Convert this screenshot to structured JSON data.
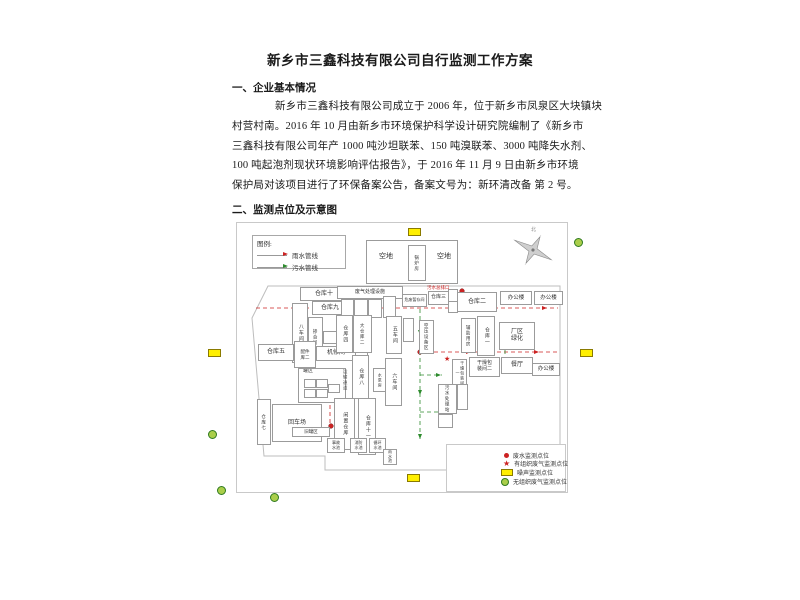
{
  "document": {
    "title": "新乡市三鑫科技有限公司自行监测工作方案",
    "section1": "一、企业基本情况",
    "paragraph": [
      "新乡市三鑫科技有限公司成立于 2006 年，位于新乡市凤泉区大块镇块",
      "村营村南。2016 年 10 月由新乡市环境保护科学设计研究院编制了《新乡市",
      "三鑫科技有限公司年产 1000 吨沙坦联苯、150 吨溴联苯、3000 吨降失水剂、",
      "100 吨起泡剂现状环境影响评估报告》，于 2016 年 11 月 9 日由新乡市环境",
      "保护局对该项目进行了环保备案公告，备案文号为：新环清改备 第 2 号。"
    ],
    "section2": "二、监测点位及示意图"
  },
  "diagram": {
    "compass_label": "北",
    "symbols": {
      "star": "★"
    },
    "pipe_legend": {
      "title": "图例:",
      "rain": "雨水管线",
      "sewage": "污水管线",
      "rain_color": "#cc2222",
      "sewage_color": "#2e8b2e"
    },
    "point_legend": [
      {
        "symbol": "red-dot",
        "label": "废水监测点位",
        "color": "#cc2222"
      },
      {
        "symbol": "red-star",
        "label": "有组织废气监测点位",
        "color": "#cc2222"
      },
      {
        "symbol": "yellow-rect",
        "label": "噪声监测点位",
        "color": "#ffef00"
      },
      {
        "symbol": "green-circle",
        "label": "无组织废气监测点位",
        "color": "#aace4a"
      }
    ],
    "labels": {
      "outlet": "污水总排口"
    },
    "buildings": {
      "empty_lot_left": "空地",
      "empty_lot_right": "空地",
      "boiler_room": "锅炉房",
      "warehouse10": "仓库十",
      "warehouse9": "仓库九",
      "workshop8": "八车间",
      "blending_room": "掺合间",
      "warehouse5": "仓库五",
      "parts_warehouse2": "配件库二",
      "machine_repair": "机修间",
      "tank_area": "罐区",
      "old_tank_area": "旧罐区",
      "warehouse7": "仓库七",
      "turning_yard": "回车场",
      "idle_warehouse": "闲置仓库",
      "warehouse11": "仓库十一",
      "transport_corridor": "运输通道",
      "warehouse8": "仓库八",
      "pump_room": "水泵房",
      "workshop6": "六车间",
      "warehouse4": "仓库四",
      "big_warehouse2": "大仓库二",
      "workshop5": "五车间",
      "air_compressor_area": "空压设备区",
      "auxiliary_room": "辅助用房",
      "warehouse1": "仓库一",
      "greening": "厂区绿化",
      "waste_gas_facility": "废气处理设施",
      "hazwaste_storage": "危废暂存间",
      "warehouse3": "仓库三",
      "warehouse2": "仓库二",
      "office1": "办公楼",
      "office2": "办公楼",
      "drying_packing1": "干燥包装间一",
      "drying_packing2": "干燥包装间二",
      "canteen": "餐厅",
      "office3": "办公楼",
      "sewage_station": "污水处理站",
      "accident_pool": "事故水池",
      "fire_pool": "消防水池",
      "cooling_pool": "循环水池",
      "rain_pool": "雨水池"
    }
  }
}
